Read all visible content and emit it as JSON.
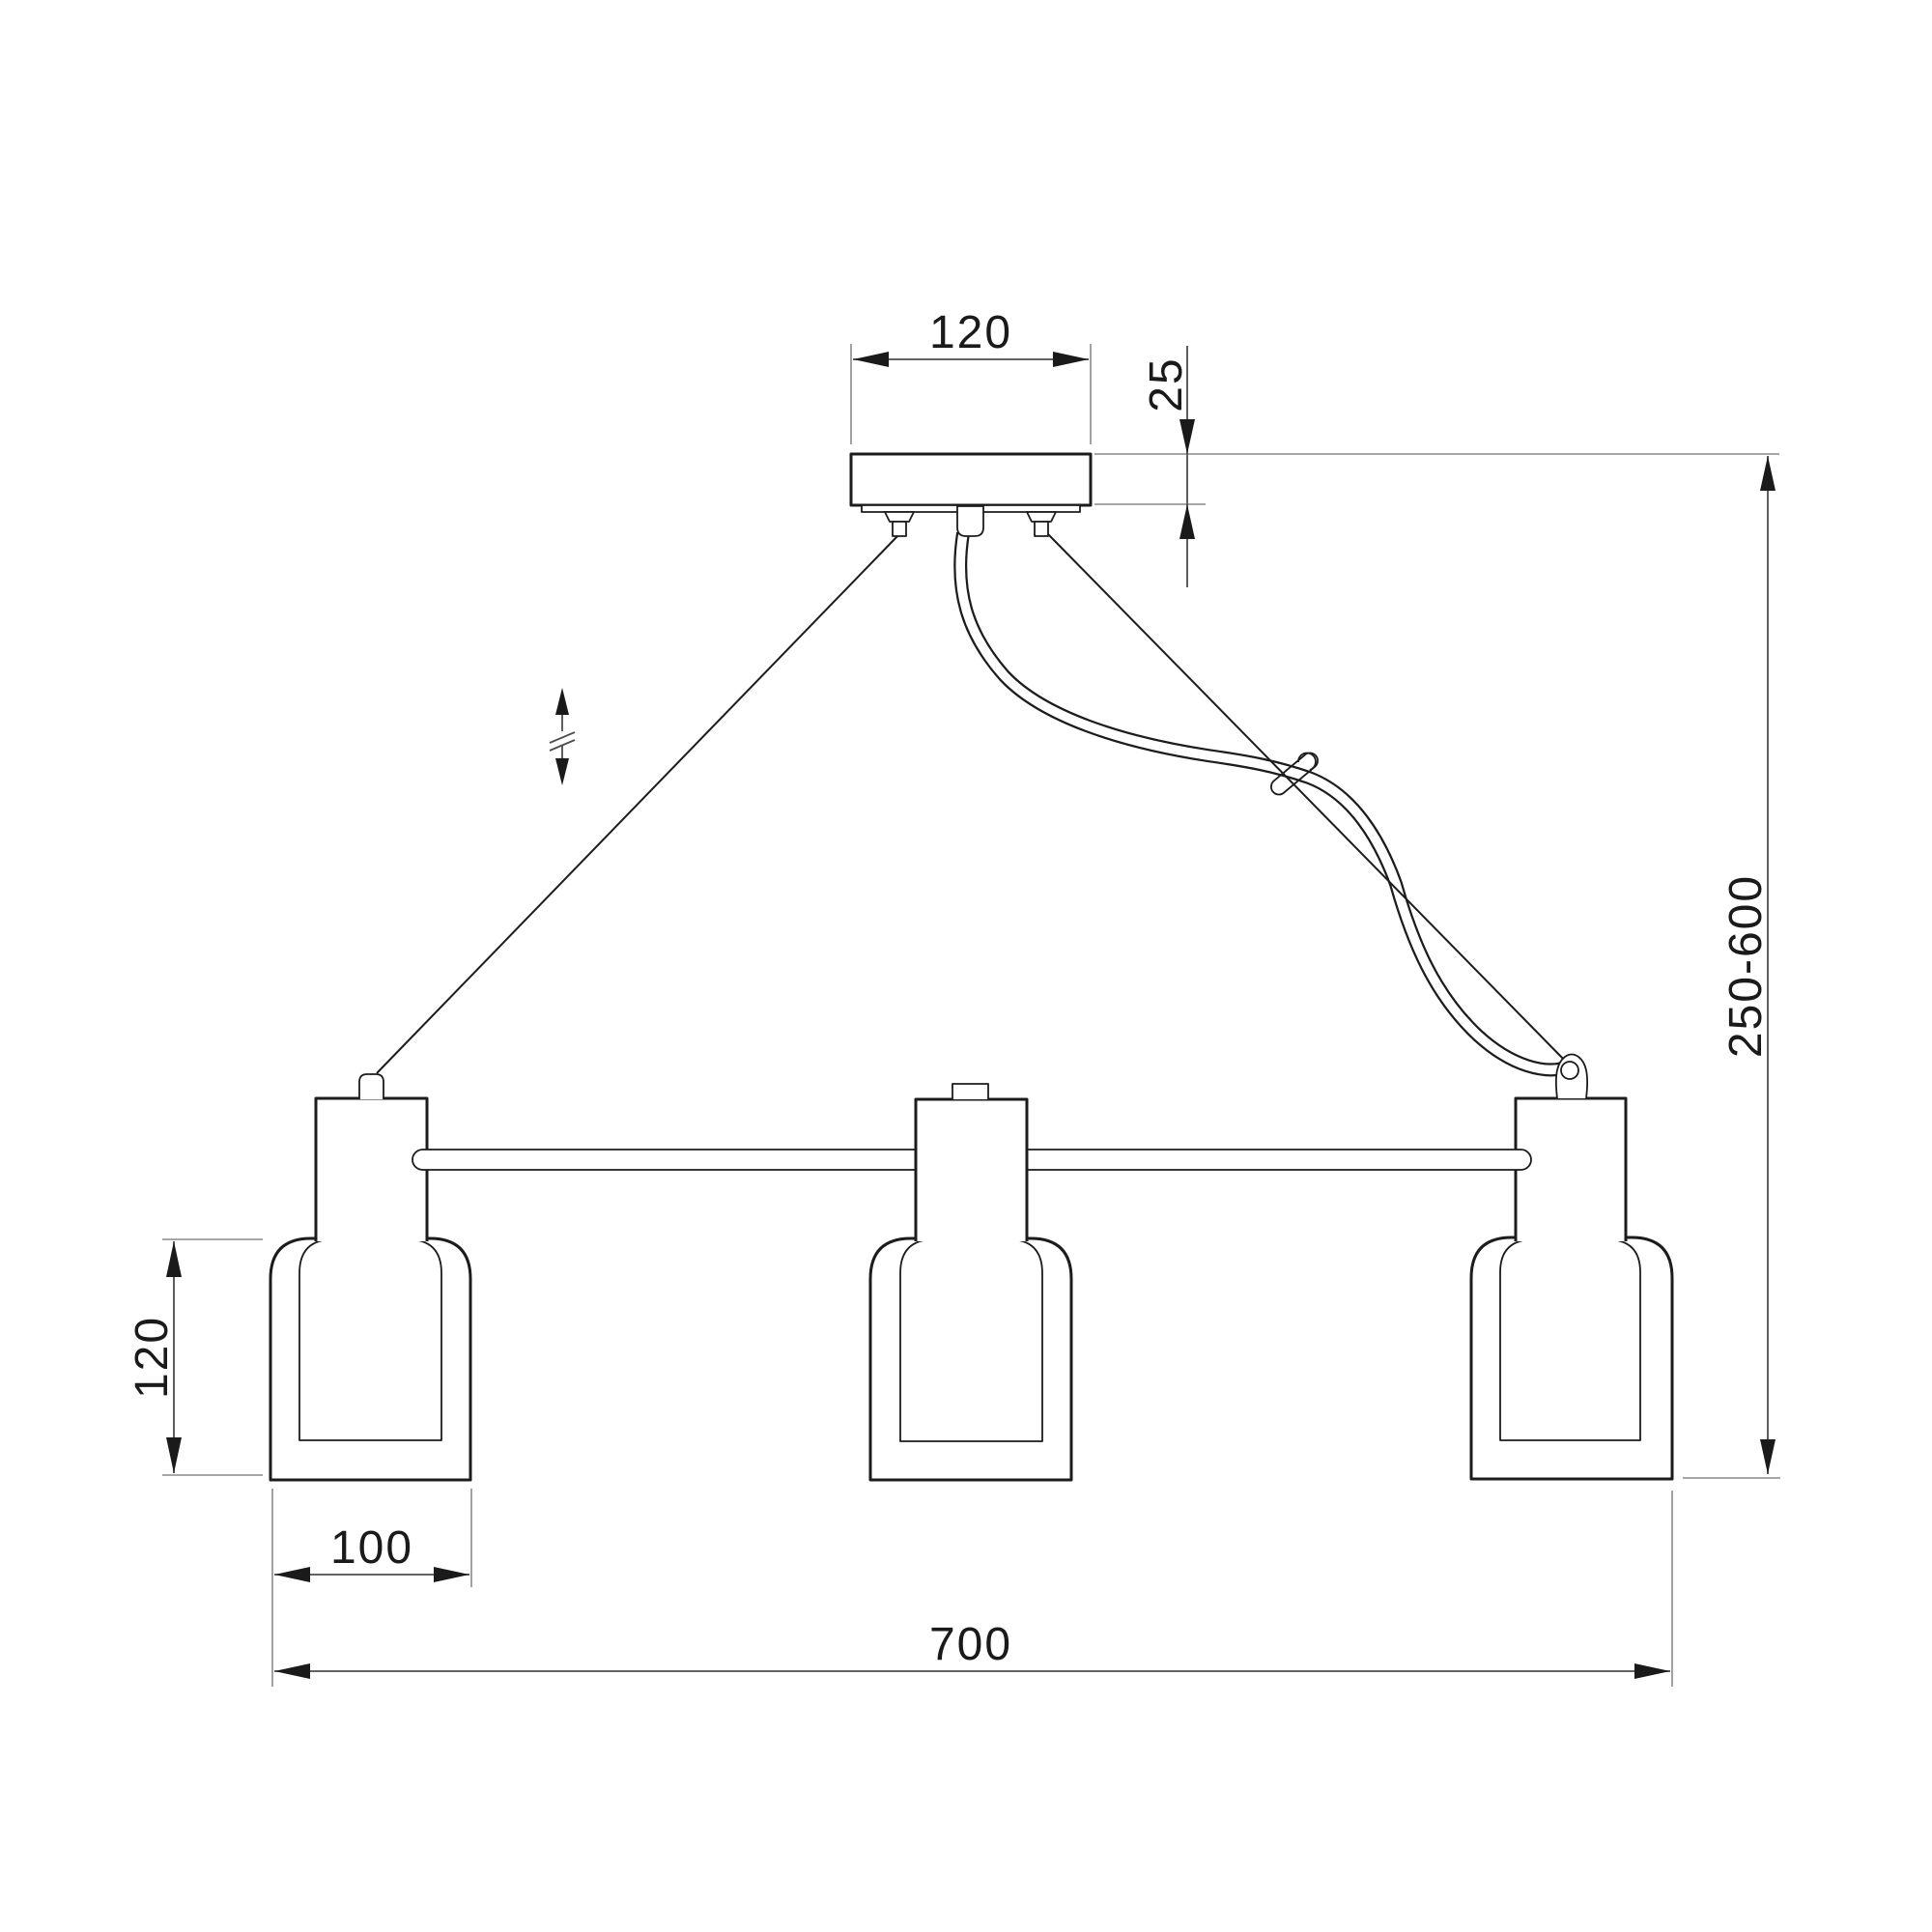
{
  "labels": {
    "canopy_width": "120",
    "canopy_depth": "25",
    "suspension_range": "250-600",
    "shade_height": "120",
    "shade_width": "100",
    "overall_width": "700"
  },
  "colors": {
    "background": "#ffffff",
    "object_line": "#1c1c1c",
    "dimension_line": "#4d4d4d",
    "extension_line": "#8a8a8a",
    "text": "#1a1a1a"
  }
}
